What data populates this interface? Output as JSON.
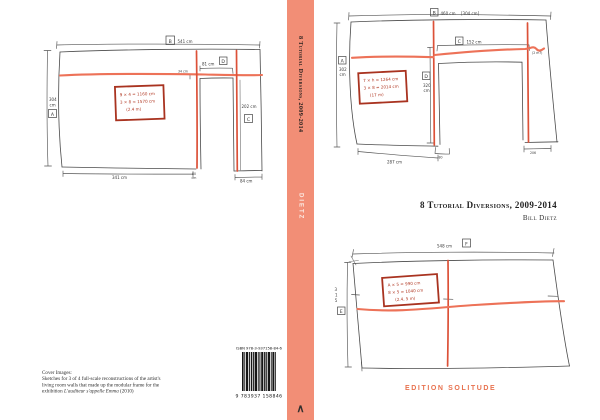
{
  "cover": {
    "title": "8 Tutorial Diversions, 2009-2014",
    "author": "Bill Dietz",
    "publisher": "EDITION SOLITUDE"
  },
  "spine": {
    "title": "8 Tutorial Diversions, 2009-2014",
    "author": "DIETZ",
    "logo_glyph": "∧"
  },
  "back": {
    "notes_heading": "Cover Images:",
    "notes_line2": "Sketches for 3 of 4 full-scale reconstructions of the artist's",
    "notes_line3": "living room walls that made up the modular frame for the",
    "notes_line4_prefix": "exhibition ",
    "notes_line4_italic": "L'auditeur s'appelle Emma",
    "notes_line4_suffix": " (2010)",
    "isbn_label": "ISBN 978-3-937158-84-6",
    "ean_digits": "9 783937 158846"
  },
  "colors": {
    "spine": "#F28E76",
    "sketch_red_vertical": "#DC5138",
    "sketch_red_horizontal": "#ED7258",
    "annotation_box_red": "#A93320",
    "publisher_text": "#E8724F"
  },
  "sketch1": {
    "top_letter": "B",
    "top_dim": "541 cm",
    "left_dim_value": "304",
    "left_dim_unit": "cm",
    "left_letter": "A",
    "door_dim": "81 cm",
    "door_letter": "D",
    "door_small": "34 cm",
    "pillar_dim": "202 cm",
    "pillar_letter": "C",
    "bottom_left_dim": "341 cm",
    "bottom_door_value": "80",
    "bottom_door_unit": "cm",
    "bottom_right_dim": "84 cm",
    "redbox": [
      "9 × 4 = 1160 cm",
      "3 × 8 = 1570 cm",
      "(2.4 m)"
    ]
  },
  "sketch2": {
    "top_letter": "B",
    "top_dim": "460 cm",
    "top_dim_alt": "[304 cm]",
    "left_letter": "A",
    "left_dim_value": "302",
    "left_dim_unit": "cm",
    "opening_letter": "C",
    "opening_dim": "152 cm",
    "right_small": "(2 m?)",
    "mid_letter": "D",
    "mid_dim_value": "320",
    "mid_dim_unit": "cm",
    "redbox": [
      "7 × h = 1264 cm",
      "3 × 8 = 2014 cm",
      "(17 m)"
    ],
    "bottom_left_dim": "287 cm",
    "bottom_mid_dim": "80",
    "bottom_right_dim": "206"
  },
  "sketch3": {
    "top_dim": "548 cm",
    "top_letter": "F",
    "left_dim_digits": [
      "3",
      "1",
      "5"
    ],
    "left_letter": "E",
    "redbox": [
      "A × 5 = 990 cm",
      "8 × 5 = 1040 cm",
      "(2.4, 5 m)"
    ]
  }
}
